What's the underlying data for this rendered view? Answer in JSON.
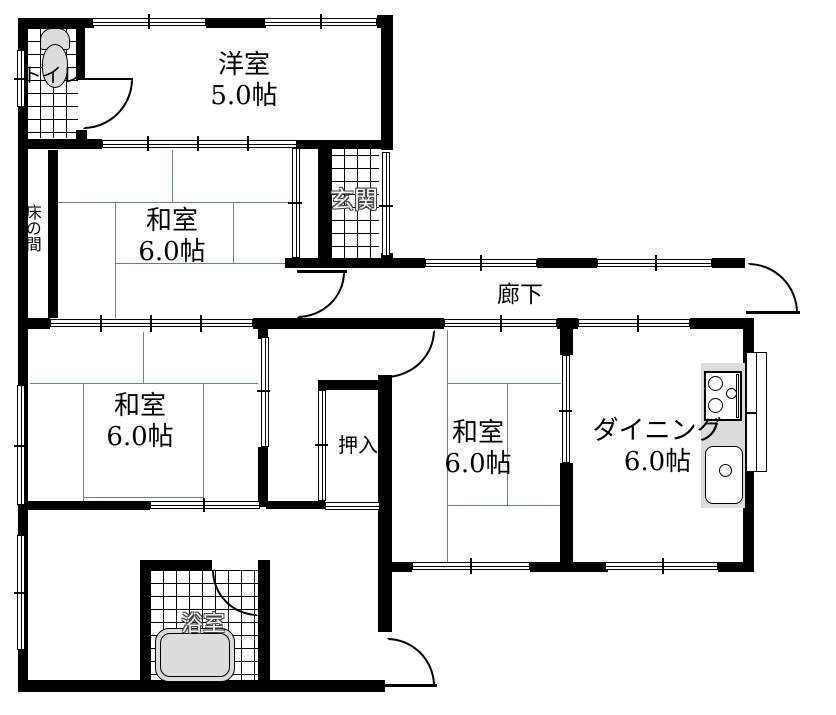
{
  "title": "間取り図",
  "colors": {
    "wall": "#000000",
    "tatami_line": "#5e905e",
    "fixture_fill": "#dcdcdc",
    "background": "#ffffff"
  },
  "rooms": {
    "toilet": {
      "label": "トイレ"
    },
    "western": {
      "label": "洋室",
      "area": "5.0帖"
    },
    "entrance": {
      "label": "玄関"
    },
    "tokonoma": {
      "label": "床の間"
    },
    "washitsu_upper": {
      "label": "和室",
      "area": "6.0帖"
    },
    "corridor": {
      "label": "廊下"
    },
    "washitsu_lower_left": {
      "label": "和室",
      "area": "6.0帖"
    },
    "closet": {
      "label": "押入"
    },
    "washitsu_lower_right": {
      "label": "和室",
      "area": "6.0帖"
    },
    "dining": {
      "label": "ダイニング",
      "area": "6.0帖"
    },
    "bathroom": {
      "label": "浴室"
    }
  },
  "fixtures": {
    "toilet_bowl": "toilet-bowl-icon",
    "bathtub": "bathtub-icon",
    "stove": "stove-burners-icon",
    "sink": "kitchen-sink-icon"
  }
}
